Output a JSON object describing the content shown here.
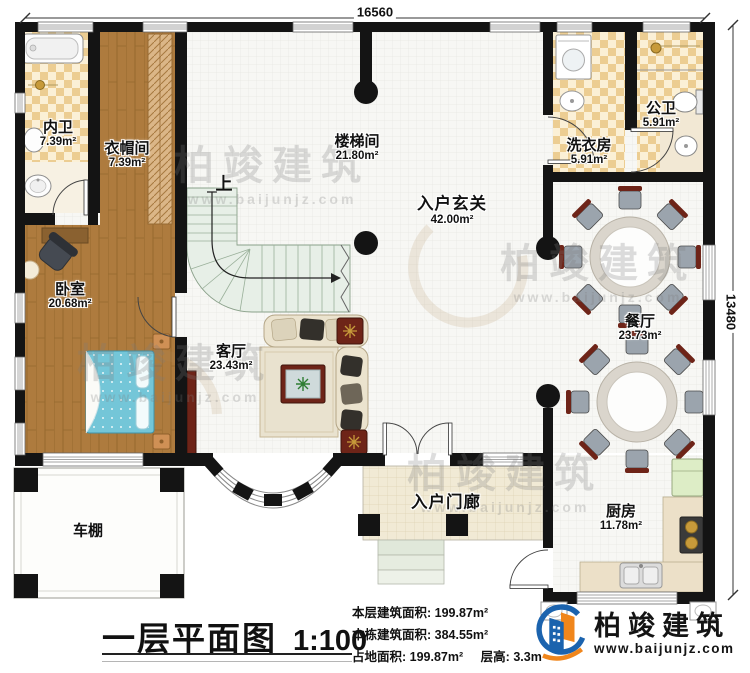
{
  "dimensions": {
    "width_mm": "16560",
    "height_mm": "13480"
  },
  "rooms": {
    "neiwei": {
      "name": "内卫",
      "area": "7.39m²"
    },
    "yimaojian": {
      "name": "衣帽间",
      "area": "7.39m²"
    },
    "loutijian": {
      "name": "楼梯间",
      "area": "21.80m²"
    },
    "xiyifang": {
      "name": "洗衣房",
      "area": "5.91m²"
    },
    "gongwei": {
      "name": "公卫",
      "area": "5.91m²"
    },
    "ruhu_xuanguan": {
      "name": "入户玄关",
      "area": "42.00m²"
    },
    "woshi": {
      "name": "卧室",
      "area": "20.68m²"
    },
    "keting": {
      "name": "客厅",
      "area": "23.43m²"
    },
    "canting": {
      "name": "餐厅",
      "area": "23.73m²"
    },
    "chufang": {
      "name": "厨房",
      "area": "11.78m²"
    },
    "ruhu_menlang": {
      "name": "入户门廊"
    },
    "chepeng": {
      "name": "车棚"
    }
  },
  "stairs": {
    "direction_label": "上"
  },
  "titleblock": {
    "title": "一层平面图",
    "scale": "1:100"
  },
  "stats": {
    "floor_area_label": "本层建筑面积:",
    "floor_area_value": "199.87m²",
    "building_area_label": "本栋建筑面积:",
    "building_area_value": "384.55m²",
    "land_area_label": "占地面积:",
    "land_area_value": "199.87m²",
    "floor_height_label": "层高:",
    "floor_height_value": "3.3m"
  },
  "brand": {
    "name": "柏竣建筑",
    "url": "www.baijunjz.com"
  },
  "watermark": {
    "text": "柏竣建筑",
    "url": "www.baijunjz.com"
  },
  "colors": {
    "brand_blue": "#1b63ae",
    "brand_orange": "#f0861c",
    "wall": "#141414",
    "wood": "#ae7b3e",
    "tile": "#eccd92",
    "bed_blue": "#74c6d8"
  }
}
